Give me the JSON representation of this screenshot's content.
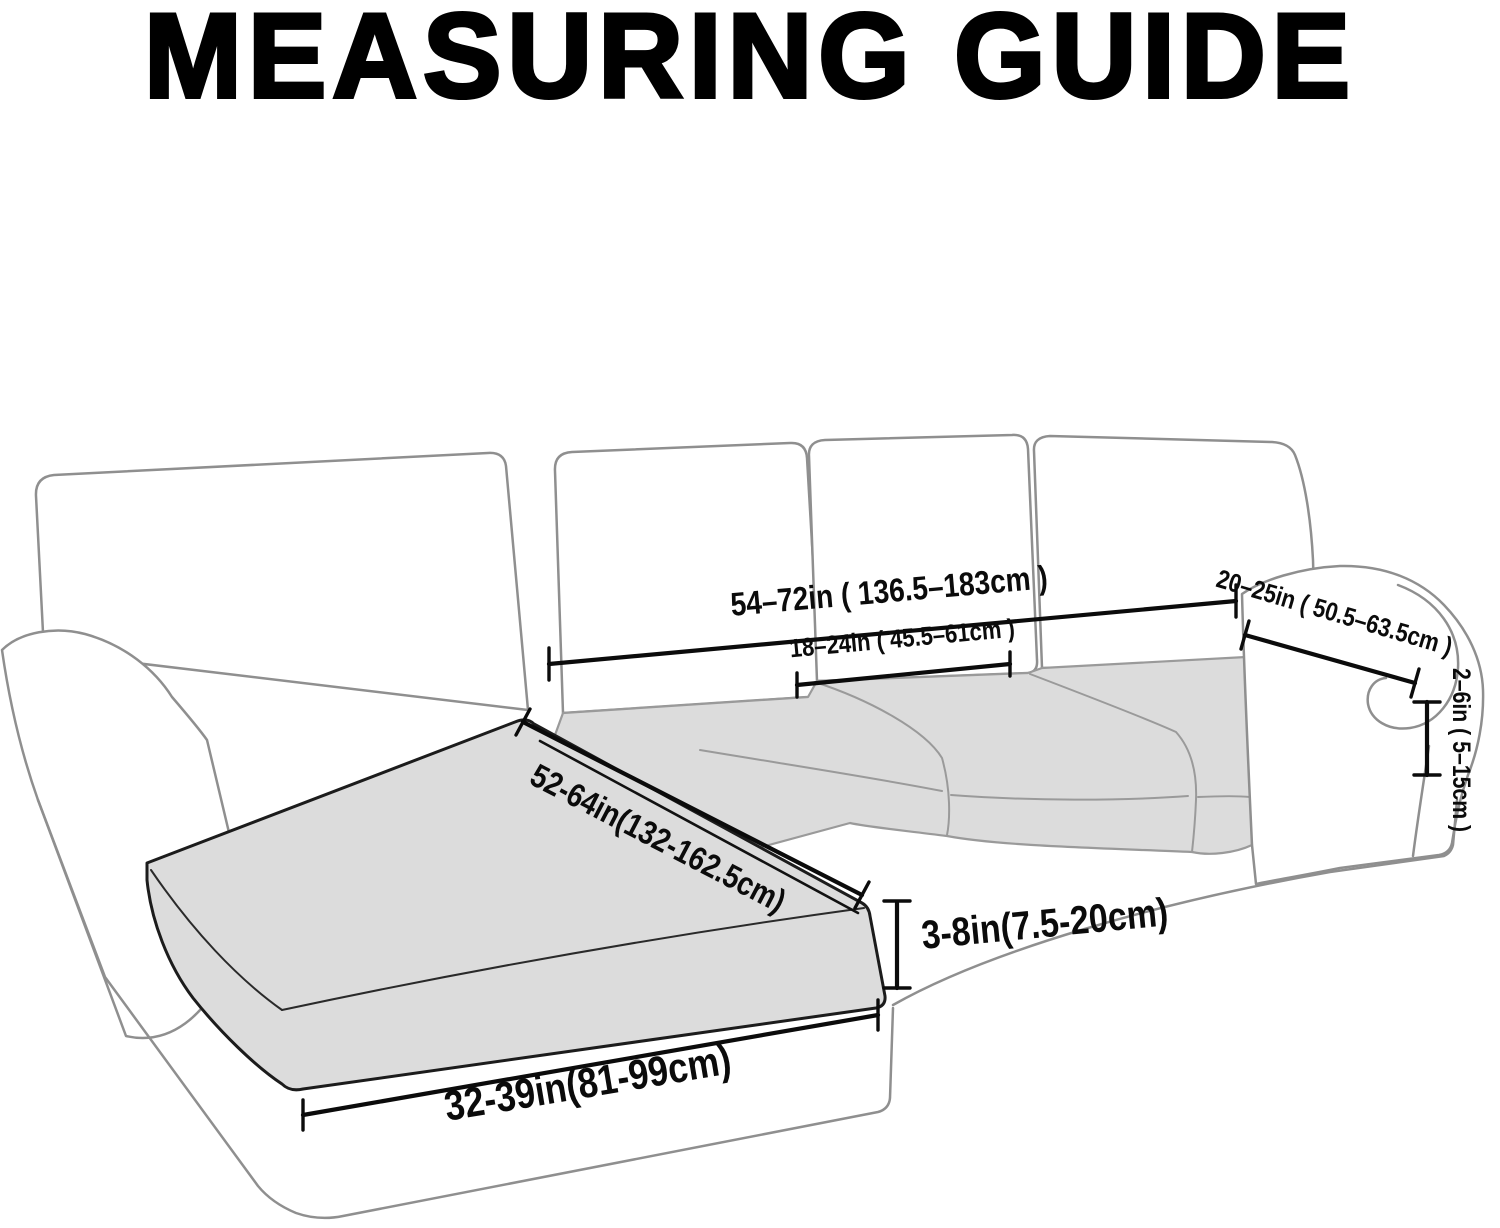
{
  "title": "MEASURING GUIDE",
  "diagram": {
    "subject": "L-shaped sectional sofa with chaise lounge, line drawing measuring guide",
    "colors": {
      "background": "#ffffff",
      "sofa_outline": "#8f8f8f",
      "cushion_fill": "#dcdcdc",
      "dimension_color": "#0b0b0b"
    },
    "measurements": {
      "back_width": "54–72in ( 136.5–183cm )",
      "back_cushion_width": "18–24in ( 45.5–61cm )",
      "arm_length": "20–25in ( 50.5–63.5cm )",
      "arm_drop": "2–6in ( 5–15cm )",
      "chaise_length": "52-64in(132-162.5cm)",
      "cushion_thickness": "3-8in(7.5-20cm)",
      "chaise_width": "32-39in(81-99cm)"
    }
  }
}
